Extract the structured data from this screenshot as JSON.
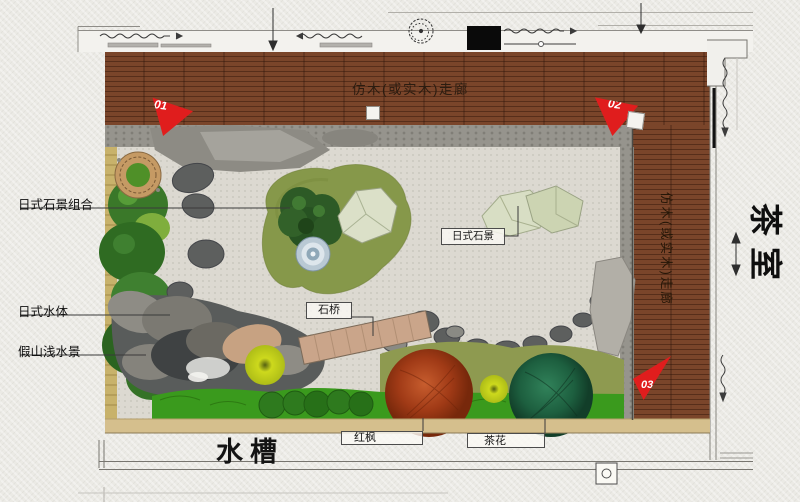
{
  "labels": {
    "top_corridor": "仿木(或实木)走廊",
    "right_corridor": "仿木(或实木)走廊",
    "tea_room": "茶室",
    "stone_combo": "日式石景组合",
    "water_body": "日式水体",
    "rockery_shallow": "假山浅水景",
    "stone_bridge": "石桥",
    "stone_scene": "日式石景",
    "water_trough": "水槽",
    "red_maple": "红枫",
    "camellia": "茶花"
  },
  "flags": {
    "f1": "01",
    "f2": "02",
    "f3": "03"
  },
  "colors": {
    "flag_red": "#e01d1d",
    "wood_deck": "#7a452a",
    "gravel": "#dcd9d1",
    "moss_island": "#86984a",
    "maple": "#a03a16",
    "camellia_green": "#1d5f3f"
  }
}
